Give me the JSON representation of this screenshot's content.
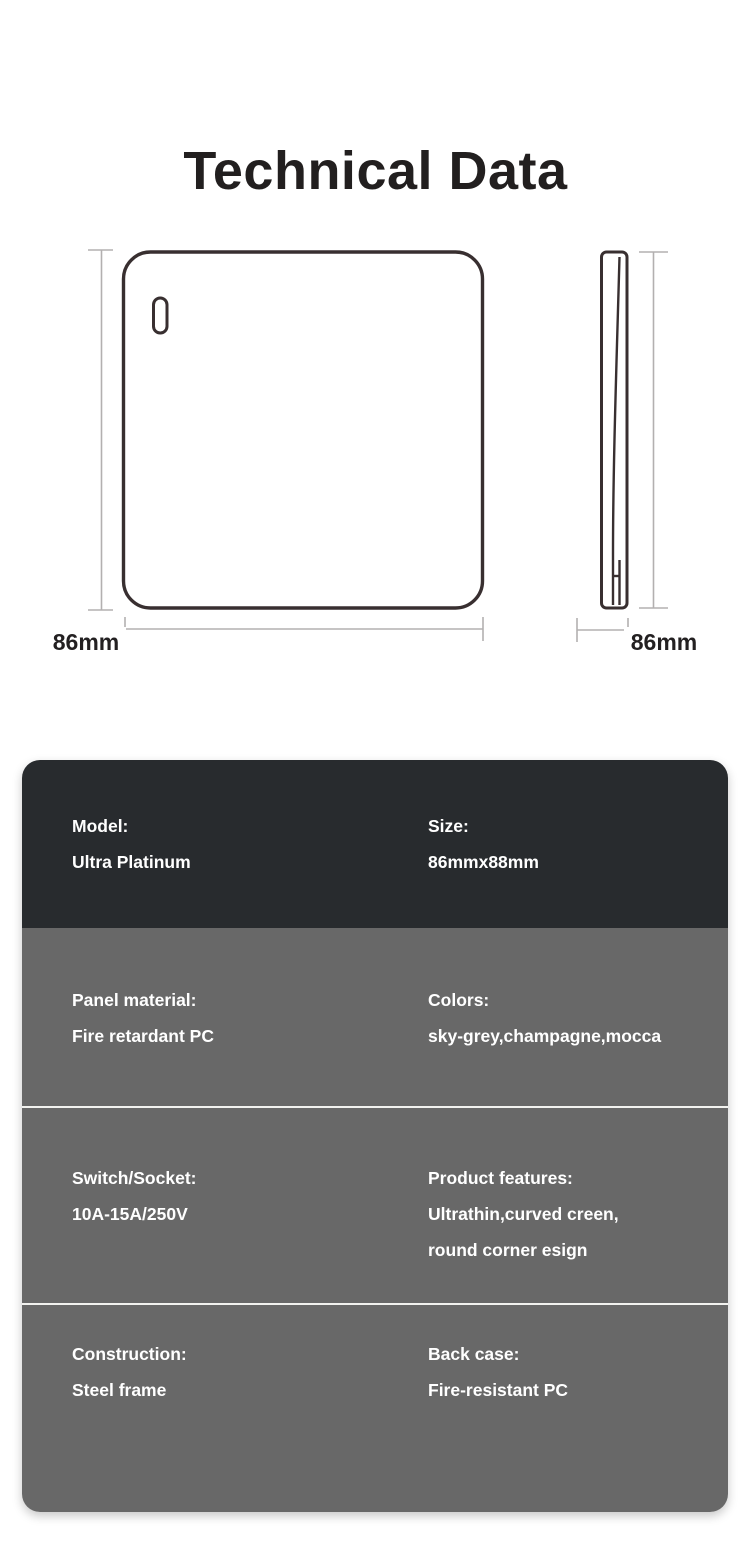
{
  "title": "Technical Data",
  "drawing": {
    "front_view": {
      "name": "switch-front-view",
      "height_label": "86mm",
      "width_label": "86mm"
    },
    "side_view": {
      "name": "switch-side-view",
      "height_label": "86mm",
      "thickness_label": "6.5mm"
    },
    "colors": {
      "outline_stroke": "#382f30",
      "dimension_line": "#b3b0b0",
      "label_text": "#232021"
    }
  },
  "spec_card": {
    "colors": {
      "header_bg": "#282b2e",
      "row_bg": "#686868",
      "divider": "#f2f2ef",
      "text": "#ffffff"
    },
    "rows": [
      {
        "left": {
          "label": "Model:",
          "value": "Ultra Platinum"
        },
        "right": {
          "label": "Size:",
          "value": "86mmx88mm"
        }
      },
      {
        "left": {
          "label": "Panel material:",
          "value": "Fire retardant PC"
        },
        "right": {
          "label": "Colors:",
          "value": "sky-grey,champagne,mocca"
        }
      },
      {
        "left": {
          "label": "Switch/Socket:",
          "value": "10A-15A/250V"
        },
        "right": {
          "label": "Product features:",
          "value_lines": [
            "Ultrathin,curved creen,",
            "round corner esign"
          ]
        }
      },
      {
        "left": {
          "label": "Construction:",
          "value": "Steel frame"
        },
        "right": {
          "label": "Back case:",
          "value": "Fire-resistant PC"
        }
      }
    ]
  }
}
